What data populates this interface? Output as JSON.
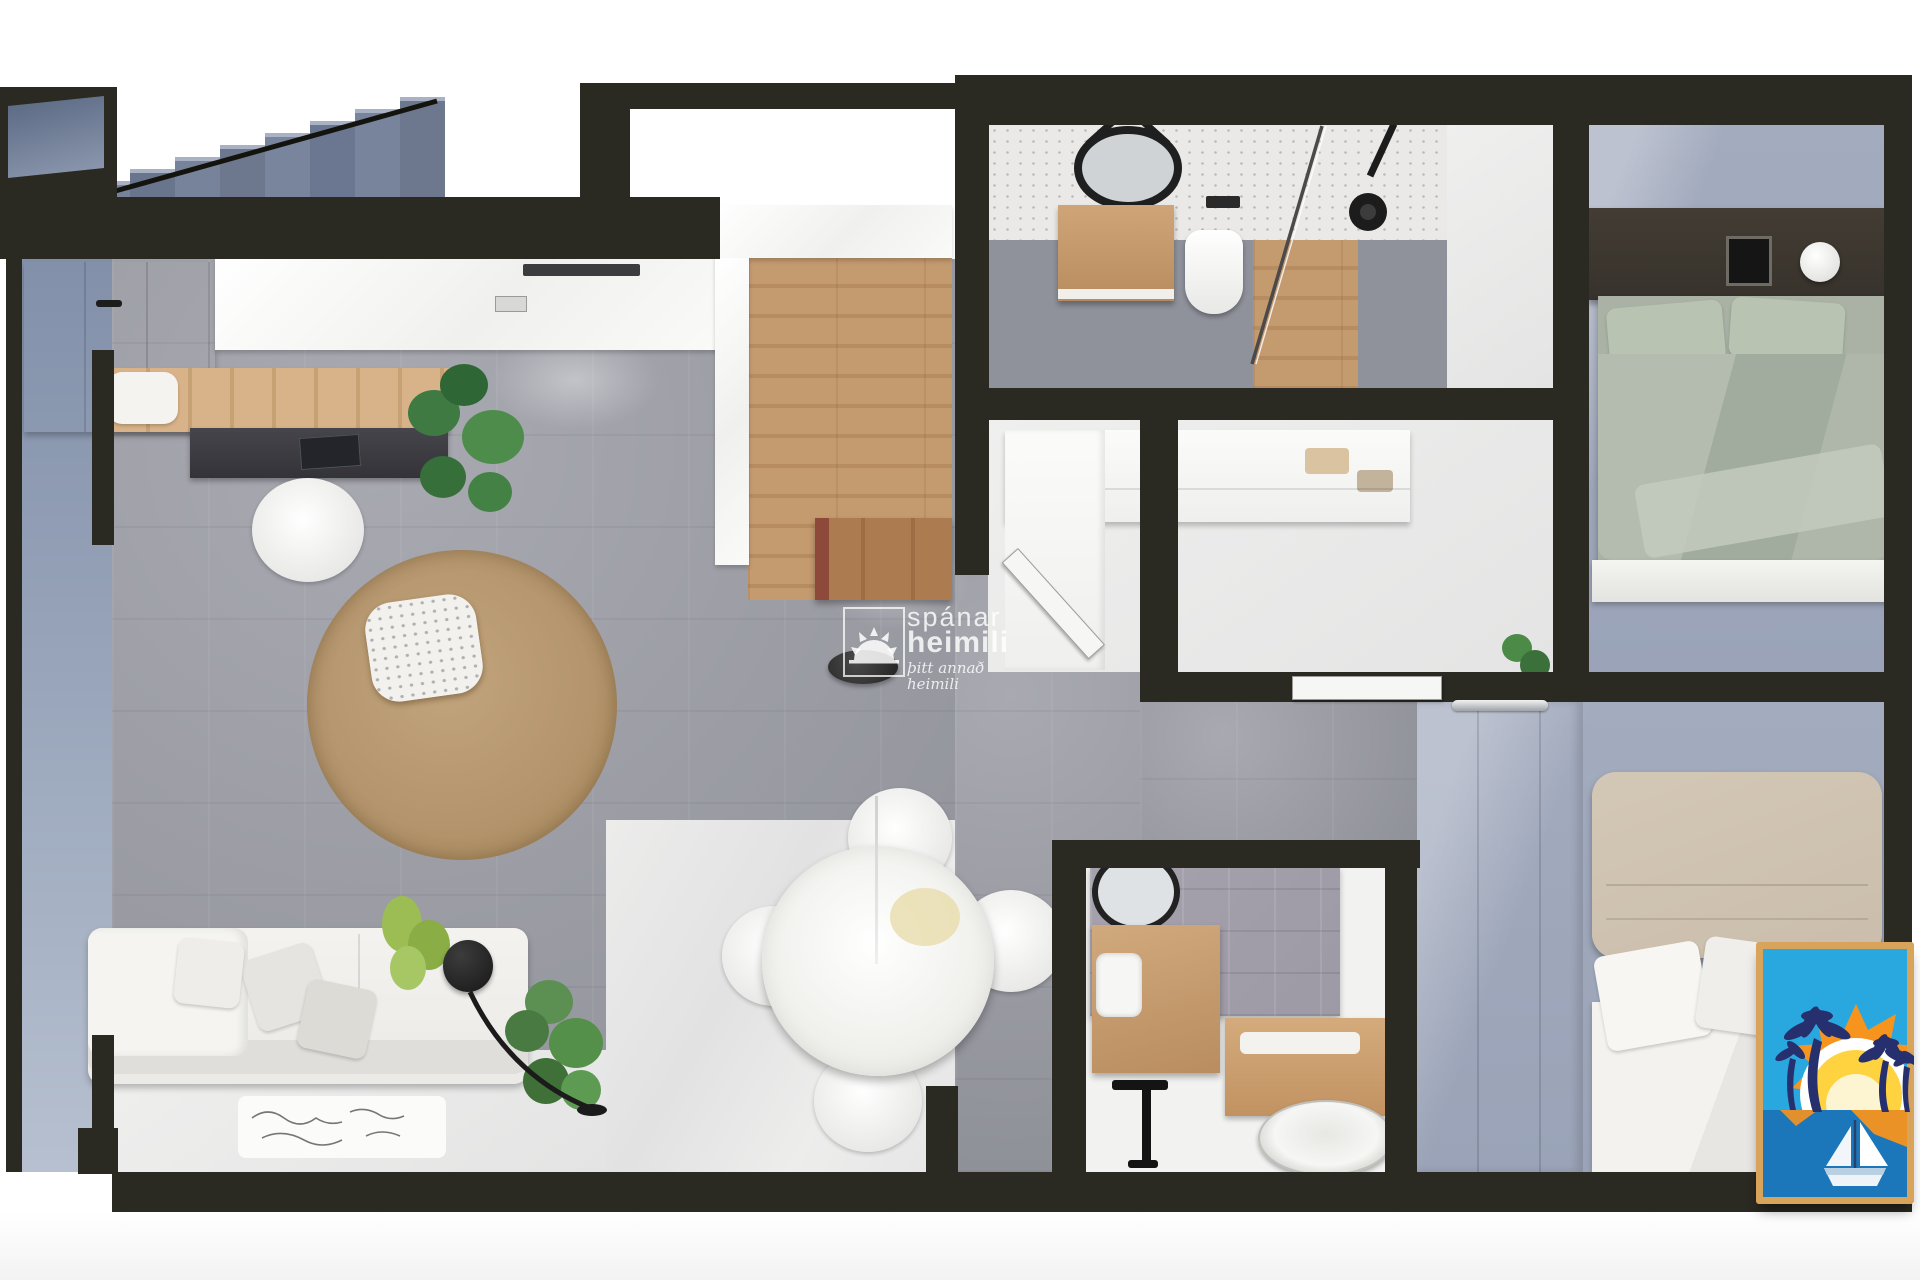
{
  "watermark": {
    "brand_line1": "spánar",
    "brand_line2": "heimili",
    "tagline": "þitt annað heimili"
  },
  "logo": {
    "border": "#d8a45c",
    "background": "#29a8df",
    "sea": "#1c76ba",
    "sun_rays": "#f7941e",
    "sun_body": "#ffd23f",
    "sun_glow": "#fdf4d2",
    "palm": "#27306e",
    "boat_hull": "#eef3f8",
    "boat_stripe": "#b9d0e2",
    "icons": [
      "sun-icon",
      "palm-tree-icon",
      "sailboat-icon"
    ]
  },
  "palette": {
    "wall": "#2a2a22",
    "wall_dark": "#1c1c17",
    "floor_living": "#9c9da5",
    "floor_living_dark": "#8e9097",
    "floor_light": "#e9e9e8",
    "floor_wood": "#c49a6f",
    "wood_dark": "#ad7b50",
    "floor_bedroom": "#9aa3b7",
    "floor_balcony": "#8c99b3",
    "floor_bath": "#8f919b",
    "tile_gray": "#9d99a5",
    "sofa": "#eceae6",
    "rug": "#b3946c",
    "bed_green": "#a9b2a4",
    "pillow_green": "#b9c3b2",
    "headboard_tan": "#cabdab",
    "headboard_dark": "#37322b",
    "plant": "#4c7f46",
    "plant_lime": "#9cbd53",
    "black": "#171717"
  }
}
